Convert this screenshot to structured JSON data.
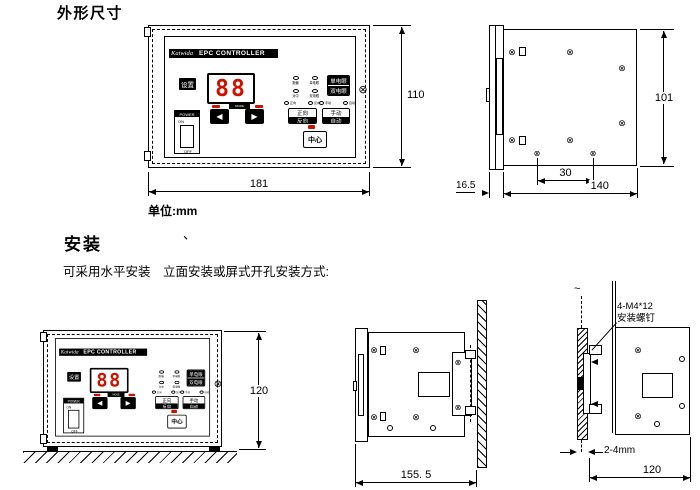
{
  "headings": {
    "dimensions_title": "外形尺寸",
    "unit_label": "单位:mm",
    "install_title": "安装",
    "install_mark": "、",
    "install_note": "可采用水平安装　立面安装或屏式开孔安装方式:"
  },
  "panel": {
    "brand": "Kaiwida",
    "title": "EPC CONTROLLER",
    "set_button": "设置",
    "display_value": "88",
    "mode_strip_label": "MODE",
    "left_arrow": "◀",
    "right_arrow": "▶",
    "power": {
      "label": "POWER",
      "on": "ON",
      "off": "OFF"
    },
    "eye_button": {
      "top": "单电眼",
      "bottom": "双电眼"
    },
    "dir_button": {
      "top": "正向",
      "bottom": "反向"
    },
    "mode_button": {
      "top": "手动",
      "bottom": "自动"
    },
    "center_button": "中心",
    "led_grid": [
      {
        "label": "跑偏"
      },
      {
        "label": "单电眼"
      },
      {
        "label": "对中"
      },
      {
        "label": "双电眼"
      }
    ],
    "dir_leds": [
      {
        "label": "正向"
      },
      {
        "label": "反向"
      }
    ],
    "mode_leds": [
      {
        "label": "手动"
      },
      {
        "label": "自动"
      }
    ]
  },
  "dimensions": {
    "front_width": "181",
    "front_height": "110",
    "bezel_depth": "16.5",
    "body_width": "140",
    "hole_pitch": "30",
    "body_height": "101",
    "install_height": "120",
    "install_depth": "155. 5",
    "panel_thickness": "2-4mm",
    "cutout_width": "120",
    "screw_callout_line1": "4-M4*12",
    "screw_callout_line2": "安装螺钉"
  },
  "colors": {
    "accent_red": "#cc1100",
    "ink": "#000000",
    "paper": "#ffffff"
  }
}
